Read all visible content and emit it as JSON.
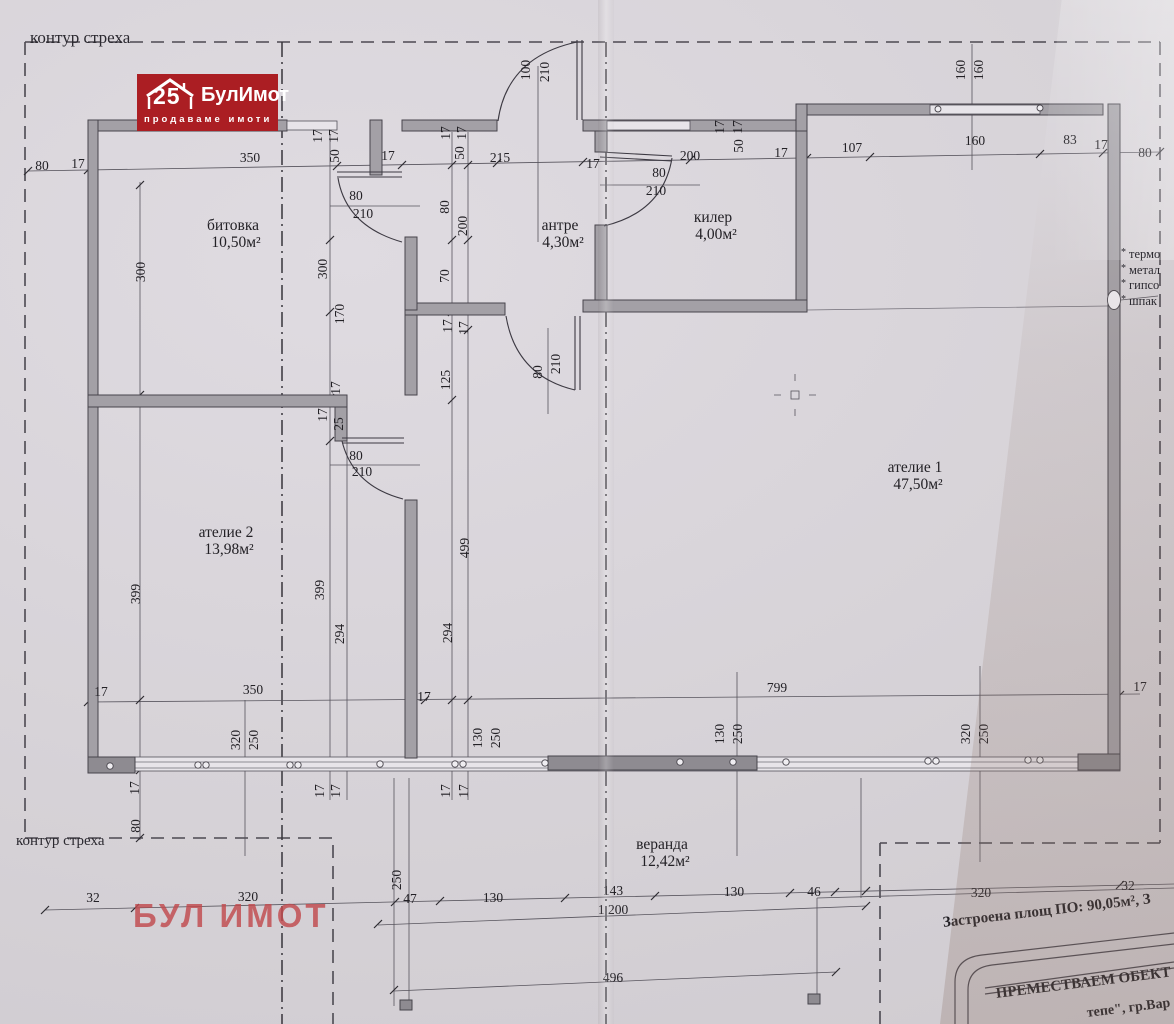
{
  "logo": {
    "number": "25",
    "name": "БулИмот",
    "tagline": "продаваме имоти"
  },
  "watermark": "БУЛ ИМОТ",
  "eave_label_top": "контур стреха",
  "eave_label_bottom": "контур стреха",
  "notes": [
    "термо",
    "метал",
    "гипсо",
    "шпак"
  ],
  "title_block": {
    "line1": "Застроена площ  ПО: 90,05м², З",
    "line2": "ПРЕМЕСТВАЕМ ОБЕКТ п",
    "line3": "тепе\", гр.Вар"
  },
  "rooms": [
    {
      "name": "битовка",
      "area": "10,50м²",
      "x": 233,
      "y": 230
    },
    {
      "name": "антре",
      "area": "4,30м²",
      "x": 560,
      "y": 230
    },
    {
      "name": "килер",
      "area": "4,00м²",
      "x": 713,
      "y": 222
    },
    {
      "name": "ателие 1",
      "area": "47,50м²",
      "x": 915,
      "y": 472
    },
    {
      "name": "ателие 2",
      "area": "13,98м²",
      "x": 226,
      "y": 537
    },
    {
      "name": "веранда",
      "area": "12,42м²",
      "x": 662,
      "y": 849
    }
  ],
  "dims": [
    {
      "t": "80",
      "x": 42,
      "y": 170
    },
    {
      "t": "17",
      "x": 78,
      "y": 168
    },
    {
      "t": "350",
      "x": 250,
      "y": 162
    },
    {
      "t": "17",
      "x": 388,
      "y": 160
    },
    {
      "t": "215",
      "x": 500,
      "y": 162
    },
    {
      "t": "17",
      "x": 593,
      "y": 168
    },
    {
      "t": "200",
      "x": 690,
      "y": 160
    },
    {
      "t": "17",
      "x": 781,
      "y": 157
    },
    {
      "t": "107",
      "x": 852,
      "y": 152
    },
    {
      "t": "160",
      "x": 975,
      "y": 145
    },
    {
      "t": "83",
      "x": 1070,
      "y": 144
    },
    {
      "t": "17",
      "x": 1101,
      "y": 149
    },
    {
      "t": "80",
      "x": 1145,
      "y": 157
    },
    {
      "t": "17",
      "x": 322,
      "y": 136,
      "r": -90
    },
    {
      "t": "17",
      "x": 338,
      "y": 136,
      "r": -90
    },
    {
      "t": "50",
      "x": 339,
      "y": 156,
      "r": -90
    },
    {
      "t": "17",
      "x": 450,
      "y": 133,
      "r": -90
    },
    {
      "t": "17",
      "x": 466,
      "y": 133,
      "r": -90
    },
    {
      "t": "50",
      "x": 464,
      "y": 153,
      "r": -90
    },
    {
      "t": "17",
      "x": 724,
      "y": 127,
      "r": -90
    },
    {
      "t": "17",
      "x": 742,
      "y": 127,
      "r": -90
    },
    {
      "t": "50",
      "x": 743,
      "y": 146,
      "r": -90
    },
    {
      "t": "100",
      "x": 530,
      "y": 70,
      "r": -90
    },
    {
      "t": "210",
      "x": 549,
      "y": 72,
      "r": -90
    },
    {
      "t": "160",
      "x": 965,
      "y": 70,
      "r": -90
    },
    {
      "t": "160",
      "x": 983,
      "y": 70,
      "r": -90
    },
    {
      "t": "80",
      "x": 356,
      "y": 200
    },
    {
      "t": "210",
      "x": 363,
      "y": 218
    },
    {
      "t": "80",
      "x": 659,
      "y": 177
    },
    {
      "t": "210",
      "x": 656,
      "y": 195
    },
    {
      "t": "80",
      "x": 356,
      "y": 460
    },
    {
      "t": "210",
      "x": 362,
      "y": 476
    },
    {
      "t": "80",
      "x": 542,
      "y": 372,
      "r": -90
    },
    {
      "t": "210",
      "x": 560,
      "y": 364,
      "r": -90
    },
    {
      "t": "300",
      "x": 145,
      "y": 272,
      "r": -90
    },
    {
      "t": "399",
      "x": 140,
      "y": 594,
      "r": -90
    },
    {
      "t": "17",
      "x": 139,
      "y": 788,
      "r": -90
    },
    {
      "t": "80",
      "x": 140,
      "y": 826,
      "r": -90
    },
    {
      "t": "300",
      "x": 327,
      "y": 269,
      "r": -90
    },
    {
      "t": "170",
      "x": 344,
      "y": 314,
      "r": -90
    },
    {
      "t": "17",
      "x": 340,
      "y": 388,
      "r": -90
    },
    {
      "t": "17",
      "x": 327,
      "y": 415,
      "r": -90
    },
    {
      "t": "25",
      "x": 343,
      "y": 424,
      "r": -90
    },
    {
      "t": "399",
      "x": 324,
      "y": 590,
      "r": -90
    },
    {
      "t": "294",
      "x": 344,
      "y": 634,
      "r": -90
    },
    {
      "t": "17",
      "x": 324,
      "y": 791,
      "r": -90
    },
    {
      "t": "17",
      "x": 340,
      "y": 791,
      "r": -90
    },
    {
      "t": "80",
      "x": 449,
      "y": 207,
      "r": -90
    },
    {
      "t": "200",
      "x": 467,
      "y": 226,
      "r": -90
    },
    {
      "t": "70",
      "x": 449,
      "y": 276,
      "r": -90
    },
    {
      "t": "17",
      "x": 452,
      "y": 326,
      "r": -90
    },
    {
      "t": "17",
      "x": 468,
      "y": 328,
      "r": -90
    },
    {
      "t": "125",
      "x": 450,
      "y": 380,
      "r": -90
    },
    {
      "t": "499",
      "x": 469,
      "y": 548,
      "r": -90
    },
    {
      "t": "294",
      "x": 452,
      "y": 633,
      "r": -90
    },
    {
      "t": "17",
      "x": 450,
      "y": 791,
      "r": -90
    },
    {
      "t": "17",
      "x": 468,
      "y": 791,
      "r": -90
    },
    {
      "t": "130",
      "x": 482,
      "y": 738,
      "r": -90
    },
    {
      "t": "250",
      "x": 500,
      "y": 738,
      "r": -90
    },
    {
      "t": "17",
      "x": 101,
      "y": 696
    },
    {
      "t": "350",
      "x": 253,
      "y": 694
    },
    {
      "t": "17",
      "x": 424,
      "y": 701
    },
    {
      "t": "799",
      "x": 777,
      "y": 692
    },
    {
      "t": "17",
      "x": 1140,
      "y": 691
    },
    {
      "t": "320",
      "x": 240,
      "y": 740,
      "r": -90
    },
    {
      "t": "250",
      "x": 258,
      "y": 740,
      "r": -90
    },
    {
      "t": "130",
      "x": 724,
      "y": 734,
      "r": -90
    },
    {
      "t": "250",
      "x": 742,
      "y": 734,
      "r": -90
    },
    {
      "t": "320",
      "x": 970,
      "y": 734,
      "r": -90
    },
    {
      "t": "250",
      "x": 988,
      "y": 734,
      "r": -90
    },
    {
      "t": "32",
      "x": 93,
      "y": 902
    },
    {
      "t": "320",
      "x": 248,
      "y": 901
    },
    {
      "t": "47",
      "x": 410,
      "y": 903
    },
    {
      "t": "130",
      "x": 493,
      "y": 902
    },
    {
      "t": "143",
      "x": 613,
      "y": 895
    },
    {
      "t": "130",
      "x": 734,
      "y": 896
    },
    {
      "t": "46",
      "x": 814,
      "y": 896
    },
    {
      "t": "1 200",
      "x": 613,
      "y": 914
    },
    {
      "t": "496",
      "x": 613,
      "y": 982
    },
    {
      "t": "320",
      "x": 981,
      "y": 897
    },
    {
      "t": "32",
      "x": 1128,
      "y": 890
    },
    {
      "t": "250",
      "x": 401,
      "y": 880,
      "r": -90
    }
  ],
  "colors": {
    "logo_red": "#ab1e23",
    "watermark_red": "#c1494d",
    "paper": "#d7d3d8",
    "wall_gray": "#a3a0a6"
  }
}
